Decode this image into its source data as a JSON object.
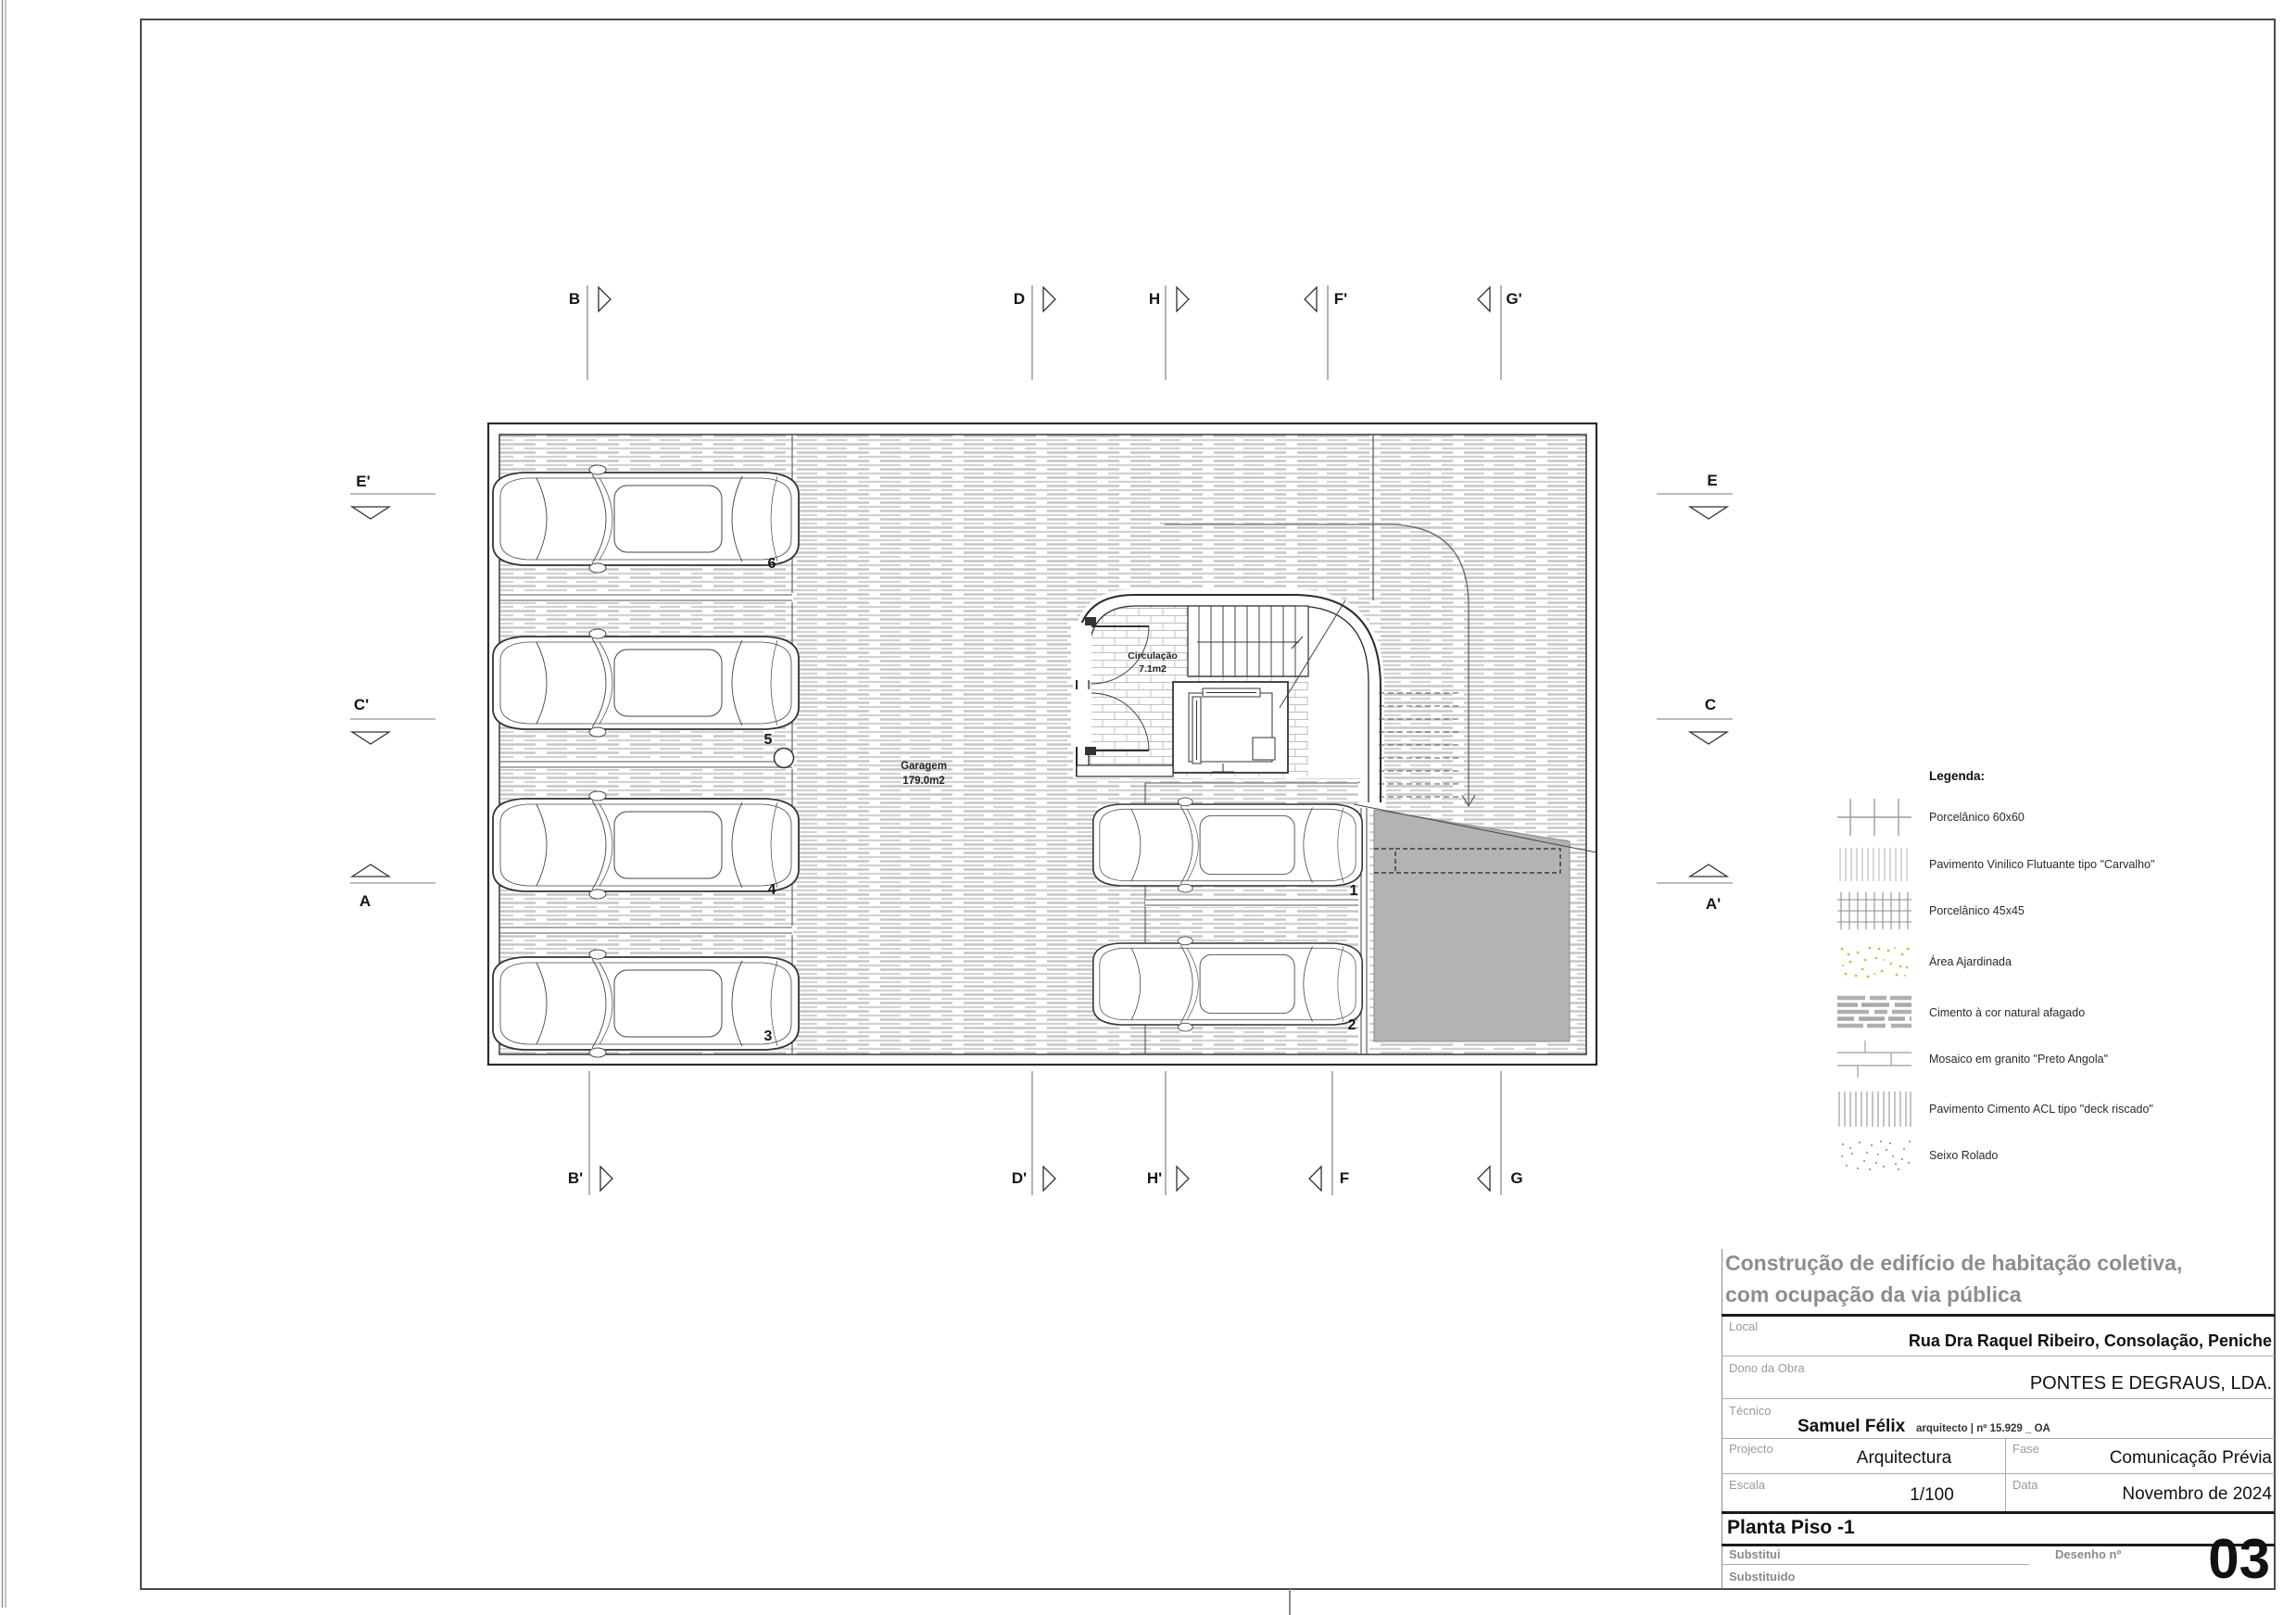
{
  "sheet": {
    "project_title_line1": "Construção de edifício de habitação coletiva,",
    "project_title_line2": "com ocupação da via pública",
    "local": {
      "label": "Local",
      "value": "Rua Dra Raquel Ribeiro, Consolação, Peniche"
    },
    "dono": {
      "label": "Dono da Obra",
      "value": "PONTES E DEGRAUS, LDA."
    },
    "tecnico": {
      "label": "Técnico",
      "name": "Samuel Félix",
      "credentials": "arquitecto | nº 15.929 _ OA"
    },
    "projecto": {
      "label": "Projecto",
      "value": "Arquitectura"
    },
    "fase": {
      "label": "Fase",
      "value": "Comunicação Prévia"
    },
    "escala": {
      "label": "Escala",
      "value": "1/100"
    },
    "data": {
      "label": "Data",
      "value": "Novembro de 2024"
    },
    "drawing_title": "Planta Piso -1",
    "substitui_label": "Substitui",
    "substituido_label": "Substituido",
    "desenho": {
      "label": "Desenho nº",
      "value": "03"
    }
  },
  "legend": {
    "title": "Legenda:",
    "items": [
      {
        "id": "porcelanico-60x60",
        "label": "Porcelânico 60x60"
      },
      {
        "id": "vinilico-carvalho",
        "label": "Pavimento Vinilico Flutuante tipo \"Carvalho\""
      },
      {
        "id": "porcelanico-45x45",
        "label": "Porcelânico 45x45"
      },
      {
        "id": "area-ajardinada",
        "label": "Área Ajardinada"
      },
      {
        "id": "cimento-afagado",
        "label": "Cimento à cor natural afagado"
      },
      {
        "id": "mosaico-granito",
        "label": "Mosaico em granito \"Preto Angola\""
      },
      {
        "id": "cimento-acl-deck",
        "label": "Pavimento Cimento ACL tipo \"deck riscado\""
      },
      {
        "id": "seixo-rolado",
        "label": "Seixo Rolado"
      }
    ]
  },
  "plan": {
    "garage": {
      "name": "Garagem",
      "area": "179.0m2"
    },
    "circulation": {
      "name": "Circulação",
      "area": "7.1m2"
    },
    "parking_space_numbers": [
      "6",
      "5",
      "4",
      "3",
      "1",
      "2"
    ],
    "section_markers": {
      "top": [
        "B",
        "D",
        "H",
        "F'",
        "G'"
      ],
      "bottom": [
        "B'",
        "D'",
        "H'",
        "F",
        "G"
      ],
      "left": [
        "E'",
        "C'",
        "A"
      ],
      "right": [
        "E",
        "C",
        "A'"
      ]
    }
  },
  "colors": {
    "drawing_line": "#2b2b2b",
    "hatch": "#c6c6c6",
    "ramp_fill": "#b3b3b3",
    "header_gray": "#8d8d8d",
    "garden_green": "#b6c94c"
  }
}
